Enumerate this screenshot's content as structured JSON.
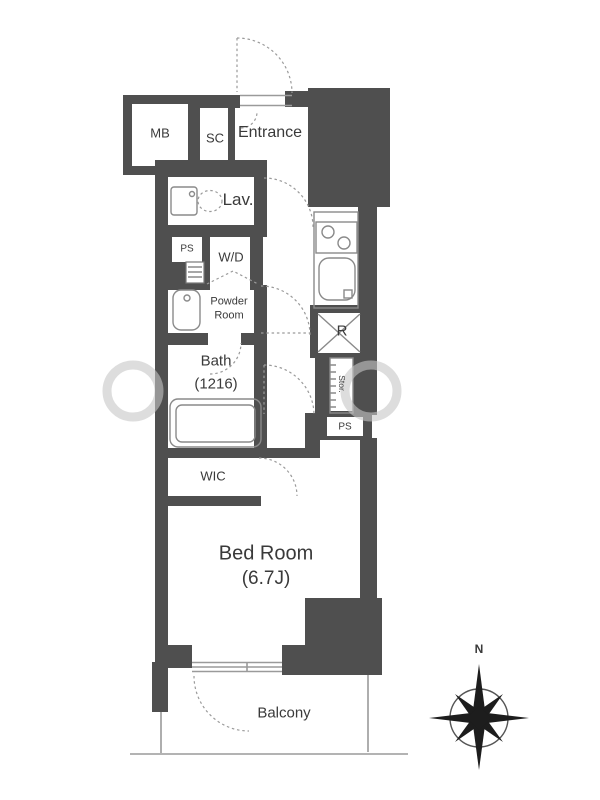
{
  "floorplan": {
    "labels": {
      "mb": "MB",
      "sc": "SC",
      "entrance": "Entrance",
      "lav": "Lav.",
      "ps_upper": "PS",
      "wd": "W/D",
      "powder_line1": "Powder",
      "powder_line2": "Room",
      "bath_line1": "Bath",
      "bath_line2": "(1216)",
      "wic": "WIC",
      "refrigerator": "R",
      "storage": "Stor.",
      "ps_lower": "PS",
      "bedroom_line1": "Bed Room",
      "bedroom_line2": "(6.7J)",
      "balcony": "Balcony",
      "compass_north": "N"
    },
    "colors": {
      "wall": "#4f4f4f",
      "fixture_line": "#8a8a8a",
      "text": "#3a3a3a",
      "watermark": "#c6c6c6"
    }
  }
}
